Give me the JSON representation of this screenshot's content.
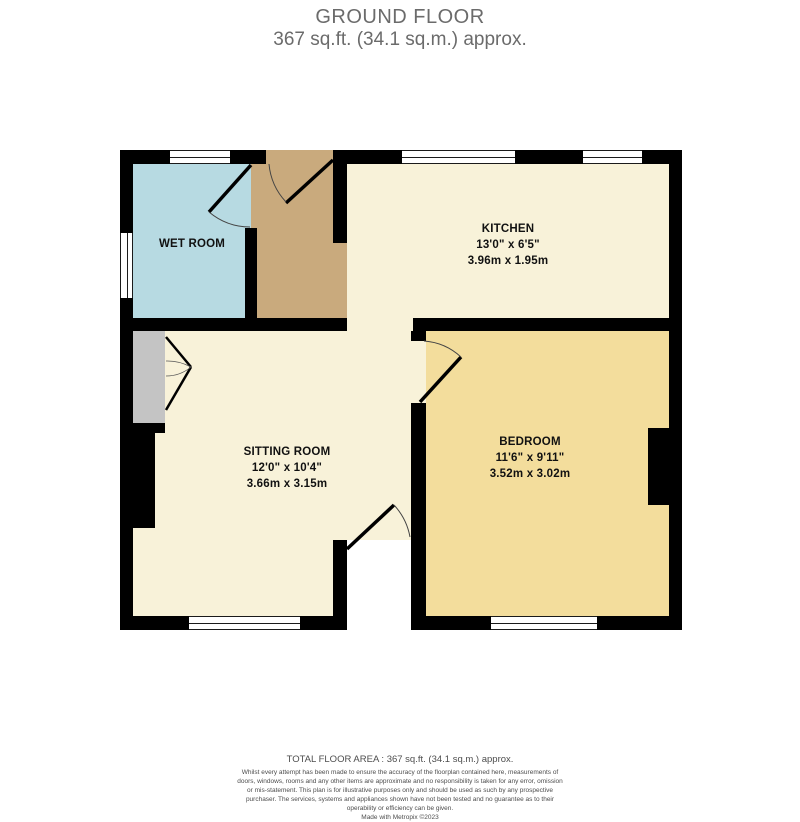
{
  "header": {
    "title": "GROUND FLOOR",
    "subtitle": "367 sq.ft. (34.1 sq.m.) approx."
  },
  "rooms": {
    "wet_room": {
      "name": "WET ROOM"
    },
    "kitchen": {
      "name": "KITCHEN",
      "dims_imperial": "13'0\" x 6'5\"",
      "dims_metric": "3.96m x 1.95m"
    },
    "sitting_room": {
      "name": "SITTING ROOM",
      "dims_imperial": "12'0\" x 10'4\"",
      "dims_metric": "3.66m x 3.15m"
    },
    "bedroom": {
      "name": "BEDROOM",
      "dims_imperial": "11'6\" x 9'11\"",
      "dims_metric": "3.52m x 3.02m"
    }
  },
  "footer": {
    "total_area": "TOTAL FLOOR AREA : 367 sq.ft. (34.1 sq.m.) approx.",
    "disclaimer": "Whilst every attempt has been made to ensure the accuracy of the floorplan contained here, measurements of doors, windows, rooms and any other items are approximate and no responsibility is taken for any error, omission or mis-statement. This plan is for illustrative purposes only and should be used as such by any prospective purchaser. The services, systems and appliances shown have not been tested and no guarantee as to their operability or efficiency can be given.",
    "credit": "Made with Metropix ©2023"
  },
  "colors": {
    "wall": "#000000",
    "wet_room_fill": "#b7dae2",
    "hall_fill": "#c9aa7d",
    "kitchen_fill": "#f8f2d9",
    "sitting_room_fill": "#f8f2d9",
    "bedroom_fill": "#f3dd9c",
    "cupboard_fill": "#c4c4c4",
    "title_text": "#6b6b6b",
    "footer_text": "#4d4d4d",
    "label_text": "#111111"
  }
}
